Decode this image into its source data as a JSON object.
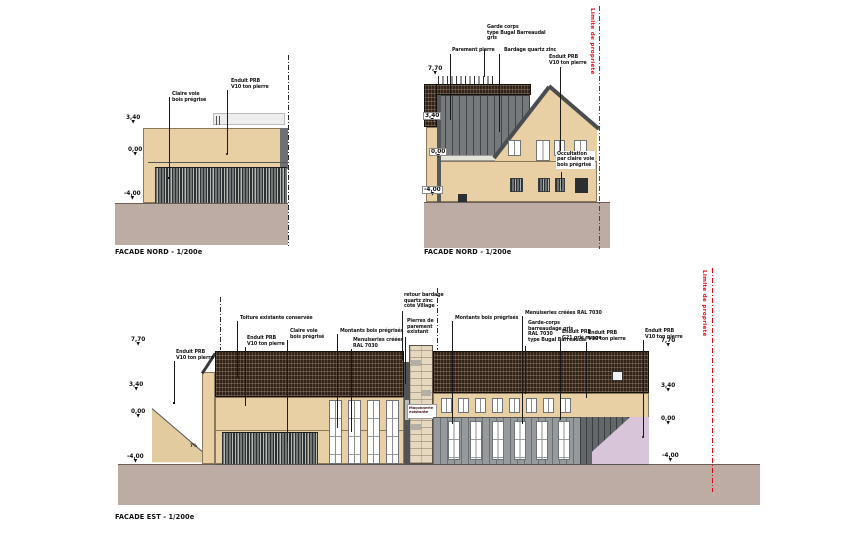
{
  "captions": {
    "nord_small": "FACADE NORD - 1/200e",
    "nord_house": "FACADE NORD - 1/200e",
    "est": "FACADE EST - 1/200e"
  },
  "property_line_label": "Limite de propriété",
  "levels": {
    "l770": "7,70",
    "l340": "3,40",
    "l000": "0,00",
    "lm400": "-4,00"
  },
  "icons": {
    "triangle_down": "▼"
  },
  "palette": {
    "wall_beige": "#e9d0a4",
    "ground_taupe": "#bcaca3",
    "roof_tile": "#31221a",
    "zinc_gray": "#75797b",
    "slat_dark": "#2d3134",
    "lilac": "#d8c5da",
    "stone": "#e6d8bf",
    "property_line_red": "#e30613"
  },
  "nord_small": {
    "labels": {
      "claire_voie": "Claire voie\nbois prégrisé",
      "enduit": "Enduit PRB\nV10 ton pierre"
    }
  },
  "nord_house": {
    "labels": {
      "garde_corps": "Garde corps\ntype Bugal Barreaudal\ngris",
      "parement": "Parement pierre",
      "bardage": "Bardage quartz zinc",
      "enduit": "Enduit PRB\nV10 ton pierre",
      "occultation": "Occultation\npar claire voie\nbois prégrisé"
    }
  },
  "est": {
    "labels": {
      "enduit_left": "Enduit PRB\nV10 ton pierre",
      "toiture": "Toiture existante conservée",
      "enduit2": "Enduit PRB\nV10 ton pierre",
      "claire_voie": "Claire voie\nbois prégrisé",
      "montants_l": "Montants bois prégrisés",
      "menuiseries_l": "Menuiseries créées\nRAL 7030",
      "retour": "retour bardage\nquartz zinc\ncôté Village",
      "pierres": "Pierres de\nparement\nexistant",
      "montants_r": "Montants bois prégrisés",
      "menuiseries_r": "Menuiseries créées RAL 7030",
      "garde_corps": "Garde-corps\nbarreaudage gris\nRAL 7030\ntype Bugal Barreaudal",
      "enduit_g21": "Enduit PRB\nG21 gris nuage",
      "enduit3": "Enduit PRB\nV10 ton pierre",
      "enduit4": "Enduit PRB\nV10 ton pierre"
    },
    "ramp_slope": "7%",
    "tower_note": "Maçonnerie\nexistante"
  }
}
